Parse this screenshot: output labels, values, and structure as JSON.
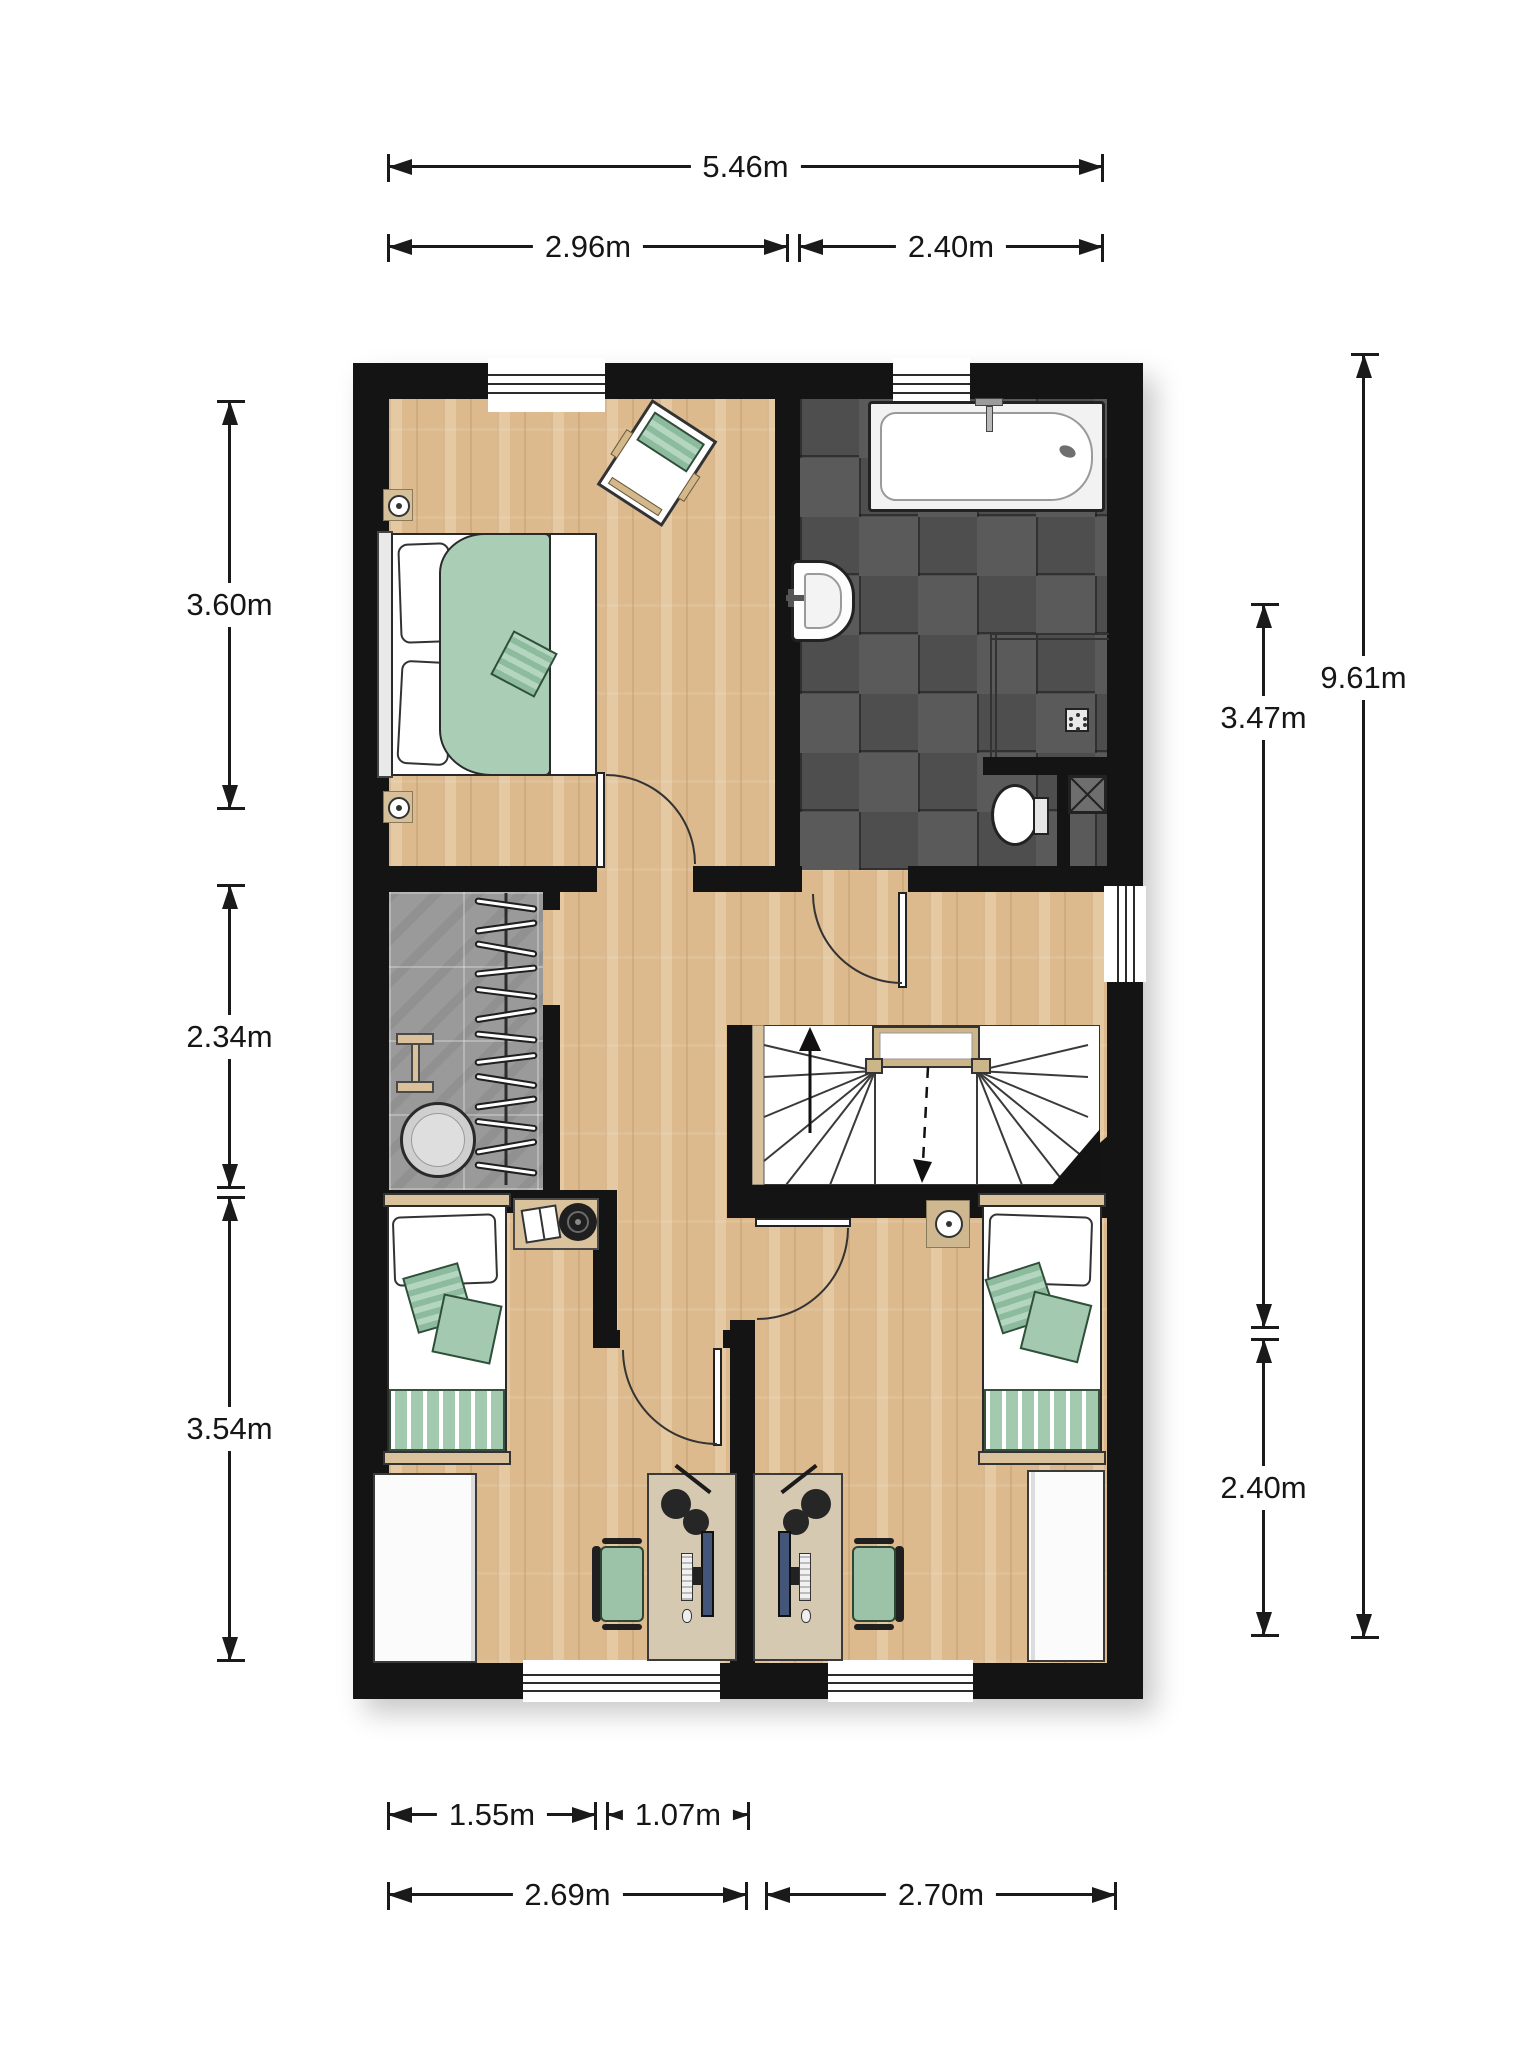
{
  "dims": {
    "top_total": "5.46m",
    "top_left": "2.96m",
    "top_right": "2.40m",
    "left_upper": "3.60m",
    "left_middle": "2.34m",
    "left_lower": "3.54m",
    "right_total": "9.61m",
    "right_middle": "3.47m",
    "right_lower": "2.40m",
    "bottom_row1_left": "1.55m",
    "bottom_row1_right": "1.07m",
    "bottom_row2_left": "2.69m",
    "bottom_row2_right": "2.70m"
  },
  "palette": {
    "wall": "#141414",
    "wood_floor": "#dcba8d",
    "bath_tile_dark": "#4e4e4e",
    "bath_tile_light": "#5a5a5a",
    "closet_floor": "#9a9a9a",
    "textile_green": "#a9cdb5",
    "textile_green_stripe": "#8dbb9d",
    "furniture_tan": "#d8c19b",
    "fixture_white": "#ffffff",
    "dimension_ink": "#1a1a1a"
  }
}
